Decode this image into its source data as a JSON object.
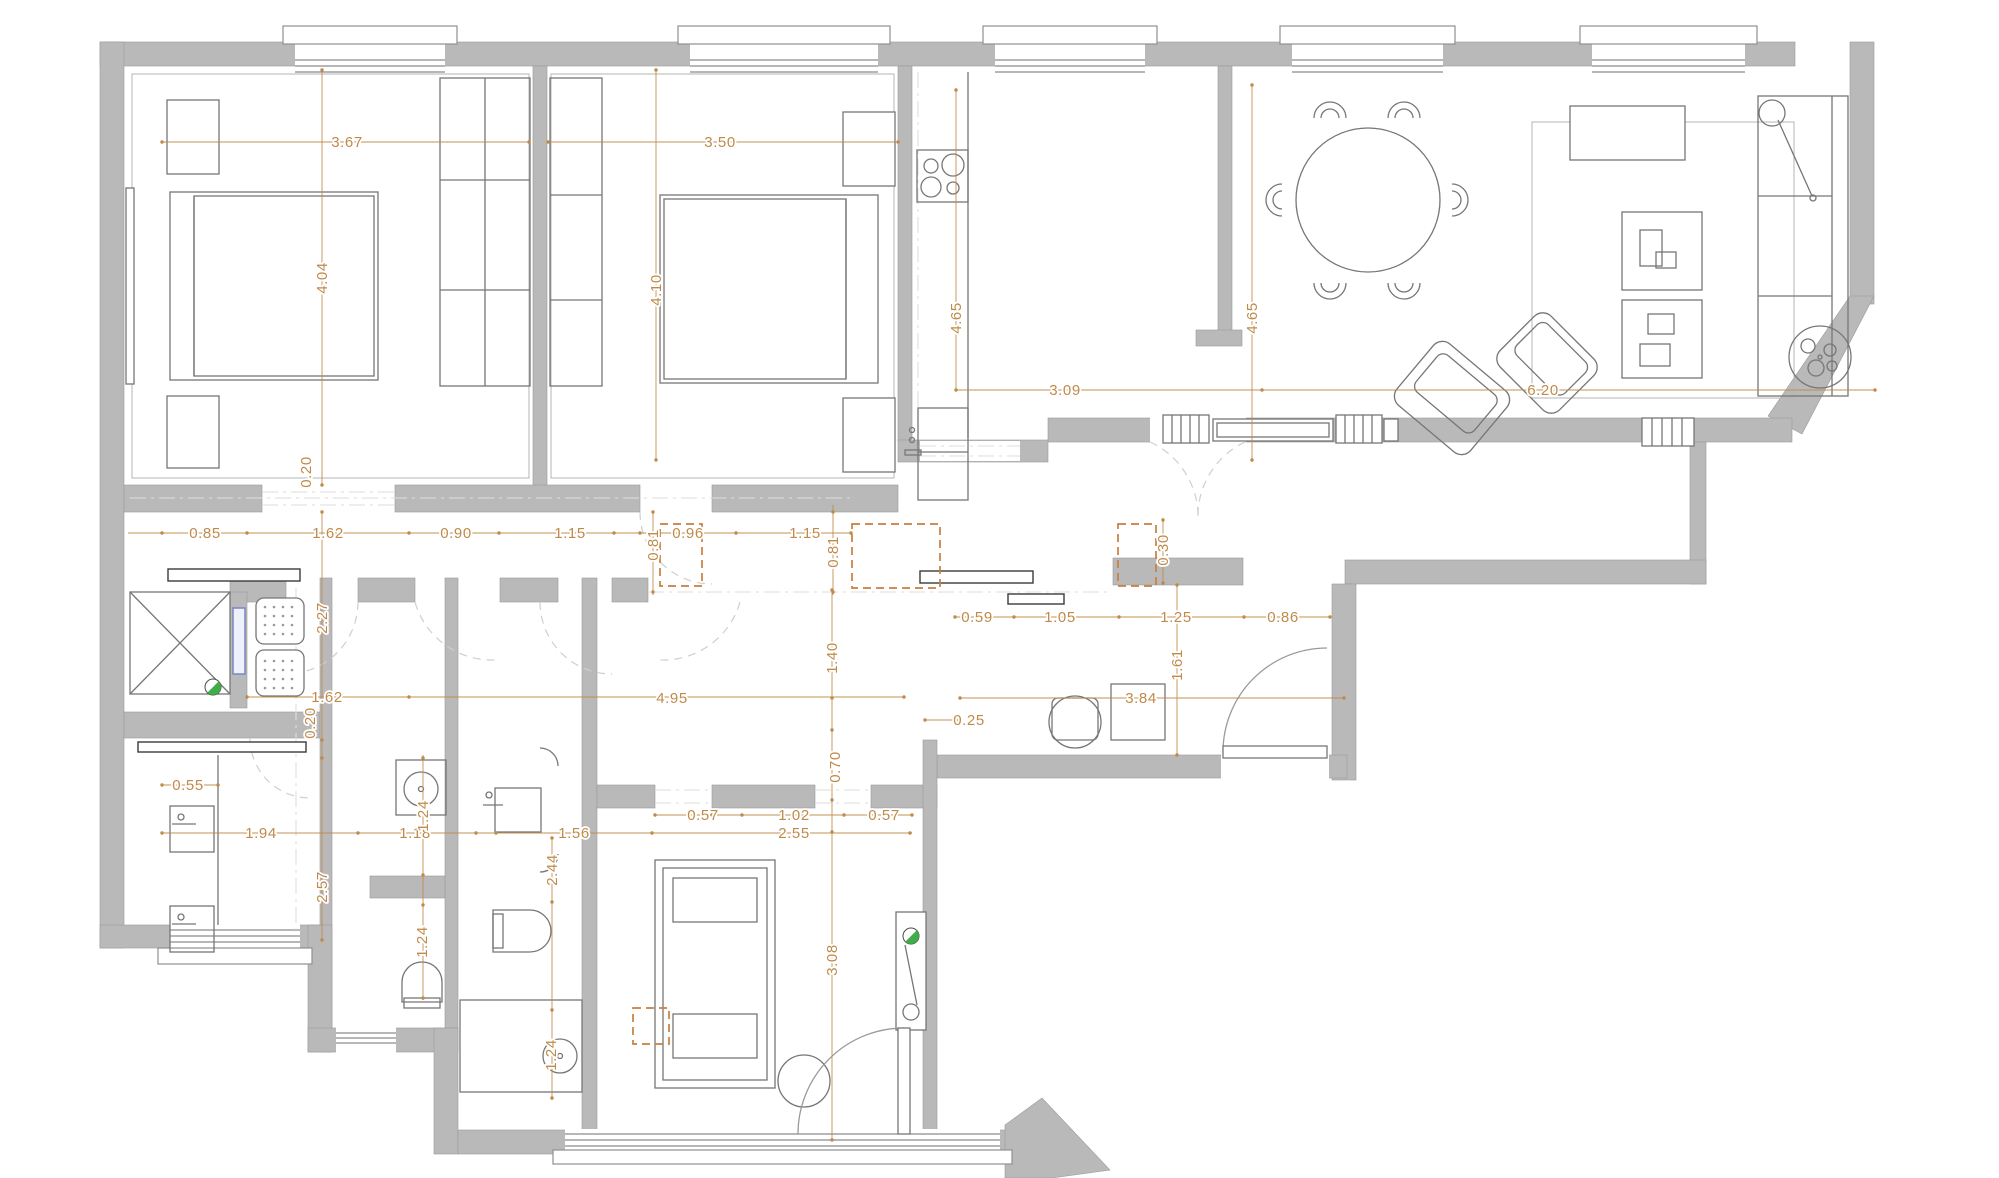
{
  "title": "Apartment floor plan with dimensions",
  "colors": {
    "wall": "#b9b9b9",
    "dimension": "#bf8a4a",
    "marker": "#c87f3f",
    "green": "#3fae49",
    "blue": "#7b86c2"
  },
  "dimensions": [
    {
      "text": "3.67",
      "x": 347,
      "y": 142,
      "v": false
    },
    {
      "text": "3.50",
      "x": 720,
      "y": 142,
      "v": false
    },
    {
      "text": "4.04",
      "x": 322,
      "y": 278,
      "v": true
    },
    {
      "text": "4.10",
      "x": 656,
      "y": 290,
      "v": true
    },
    {
      "text": "4.65",
      "x": 956,
      "y": 318,
      "v": true
    },
    {
      "text": "4.65",
      "x": 1252,
      "y": 318,
      "v": true
    },
    {
      "text": "3.09",
      "x": 1065,
      "y": 390,
      "v": false
    },
    {
      "text": "6.20",
      "x": 1543,
      "y": 390,
      "v": false
    },
    {
      "text": "0.20",
      "x": 306,
      "y": 472,
      "v": true
    },
    {
      "text": "0.85",
      "x": 205,
      "y": 533,
      "v": false
    },
    {
      "text": "1.62",
      "x": 328,
      "y": 533,
      "v": false
    },
    {
      "text": "0.90",
      "x": 456,
      "y": 533,
      "v": false
    },
    {
      "text": "1.15",
      "x": 570,
      "y": 533,
      "v": false
    },
    {
      "text": "0.96",
      "x": 688,
      "y": 533,
      "v": false
    },
    {
      "text": "1.15",
      "x": 805,
      "y": 533,
      "v": false
    },
    {
      "text": "0.81",
      "x": 653,
      "y": 545,
      "v": true
    },
    {
      "text": "0.81",
      "x": 833,
      "y": 552,
      "v": true
    },
    {
      "text": "0.30",
      "x": 1163,
      "y": 550,
      "v": true
    },
    {
      "text": "0.59",
      "x": 977,
      "y": 617,
      "v": false
    },
    {
      "text": "1.05",
      "x": 1060,
      "y": 617,
      "v": false
    },
    {
      "text": "1.25",
      "x": 1176,
      "y": 617,
      "v": false
    },
    {
      "text": "0.86",
      "x": 1283,
      "y": 617,
      "v": false
    },
    {
      "text": "2.27",
      "x": 322,
      "y": 618,
      "v": true
    },
    {
      "text": "1.62",
      "x": 327,
      "y": 697,
      "v": false
    },
    {
      "text": "0.20",
      "x": 310,
      "y": 723,
      "v": true
    },
    {
      "text": "4.95",
      "x": 672,
      "y": 698,
      "v": false
    },
    {
      "text": "1.40",
      "x": 832,
      "y": 658,
      "v": true
    },
    {
      "text": "1.61",
      "x": 1177,
      "y": 665,
      "v": true
    },
    {
      "text": "3.84",
      "x": 1141,
      "y": 698,
      "v": false
    },
    {
      "text": "0.25",
      "x": 969,
      "y": 720,
      "v": false
    },
    {
      "text": "0.55",
      "x": 188,
      "y": 785,
      "v": false
    },
    {
      "text": "1.94",
      "x": 261,
      "y": 833,
      "v": false
    },
    {
      "text": "1.18",
      "x": 415,
      "y": 833,
      "v": false
    },
    {
      "text": "1.24",
      "x": 423,
      "y": 816,
      "v": true
    },
    {
      "text": "2.57",
      "x": 322,
      "y": 887,
      "v": true
    },
    {
      "text": "1.24",
      "x": 422,
      "y": 942,
      "v": true
    },
    {
      "text": "1.56",
      "x": 574,
      "y": 833,
      "v": false
    },
    {
      "text": "2.44",
      "x": 552,
      "y": 870,
      "v": true
    },
    {
      "text": "0.57",
      "x": 703,
      "y": 815,
      "v": false
    },
    {
      "text": "1.02",
      "x": 794,
      "y": 815,
      "v": false
    },
    {
      "text": "0.57",
      "x": 884,
      "y": 815,
      "v": false
    },
    {
      "text": "2.55",
      "x": 794,
      "y": 833,
      "v": false
    },
    {
      "text": "0.70",
      "x": 835,
      "y": 767,
      "v": true
    },
    {
      "text": "3.08",
      "x": 832,
      "y": 960,
      "v": true
    },
    {
      "text": "1.24",
      "x": 551,
      "y": 1055,
      "v": true
    }
  ]
}
